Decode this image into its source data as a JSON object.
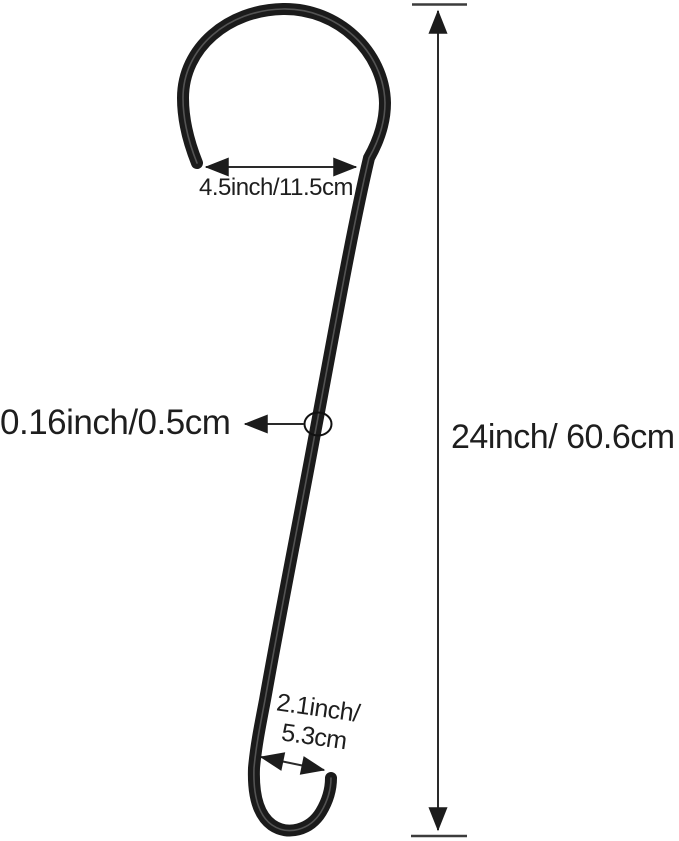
{
  "diagram": {
    "title": "extension hook dimension diagram",
    "labels": {
      "top_width": "4.5inch/11.5cm",
      "wire_thickness": "0.16inch/0.5cm",
      "overall_height": "24inch/ 60.6cm",
      "bottom_width_line1": "2.1inch/",
      "bottom_width_line2": "5.3cm"
    },
    "colors": {
      "background": "#ffffff",
      "wire": "#1b1b1b",
      "wire_highlight": "#5a5a5a",
      "dimension_line": "#2a2a2a",
      "arrowhead": "#1c1c1c",
      "text": "#1e1e1e"
    }
  }
}
